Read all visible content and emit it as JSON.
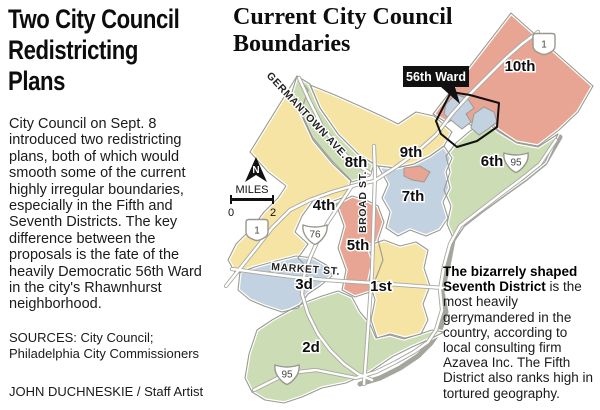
{
  "panel": {
    "headline_lines": [
      "Two City Council",
      "Redistricting",
      "Plans"
    ],
    "body": "City Council on Sept. 8 introduced two redistricting plans, both of which would smooth some of the current highly irregular boundaries, especially in the Fifth and Seventh Districts. The key difference between the proposals is the fate of the heavily Democratic 56th Ward in the city's Rhawnhurst neighborhood.",
    "sources_line1": "SOURCES: City Council;",
    "sources_line2": "Philadelphia City Commissioners",
    "credit": "JOHN DUCHNESKIE / Staff Artist"
  },
  "map": {
    "title_line1": "Current City Council",
    "title_line2": "Boundaries",
    "ward_callout": "56th Ward",
    "districts": [
      {
        "id": "10th",
        "label": "10th",
        "color": "#e8a594"
      },
      {
        "id": "9th",
        "label": "9th",
        "color": "#f6e4a4"
      },
      {
        "id": "8th",
        "label": "8th",
        "color": "#ccdcb4"
      },
      {
        "id": "7th",
        "label": "7th",
        "color": "#c3d2e0"
      },
      {
        "id": "6th",
        "label": "6th",
        "color": "#ccdcb4"
      },
      {
        "id": "5th",
        "label": "5th",
        "color": "#e8a594"
      },
      {
        "id": "4th",
        "label": "4th",
        "color": "#f6e4a4"
      },
      {
        "id": "3d",
        "label": "3d",
        "color": "#c3d2e0"
      },
      {
        "id": "2d",
        "label": "2d",
        "color": "#ccdcb4"
      },
      {
        "id": "1st",
        "label": "1st",
        "color": "#f6e4a4"
      }
    ],
    "streets": {
      "germantown": "GERMANTOWN AVE.",
      "broad": "BROAD ST.",
      "market": "MARKET ST."
    },
    "shields": {
      "us1_upper": "1",
      "us1_lower": "1",
      "i76": "76",
      "i95_upper": "95",
      "i95_lower": "95"
    },
    "compass_n": "N",
    "scale": {
      "label": "MILES",
      "min": "0",
      "max": "2"
    },
    "colors": {
      "district_yellow": "#f6e4a4",
      "district_green": "#ccdcb4",
      "district_salmon": "#e8a594",
      "district_blue": "#c3d2e0",
      "boundary_gray": "#9a9a92",
      "road_casing": "#a8a8a0",
      "river_gray": "#a5a59d",
      "callout_bg": "#111111"
    }
  },
  "annotation": {
    "bold_text": "The bizarrely shaped Seventh District",
    "regular_text": " is the most heavily gerrymandered in the country, according to local consulting firm Azavea Inc. The Fifth District also ranks high in tortured geography."
  }
}
